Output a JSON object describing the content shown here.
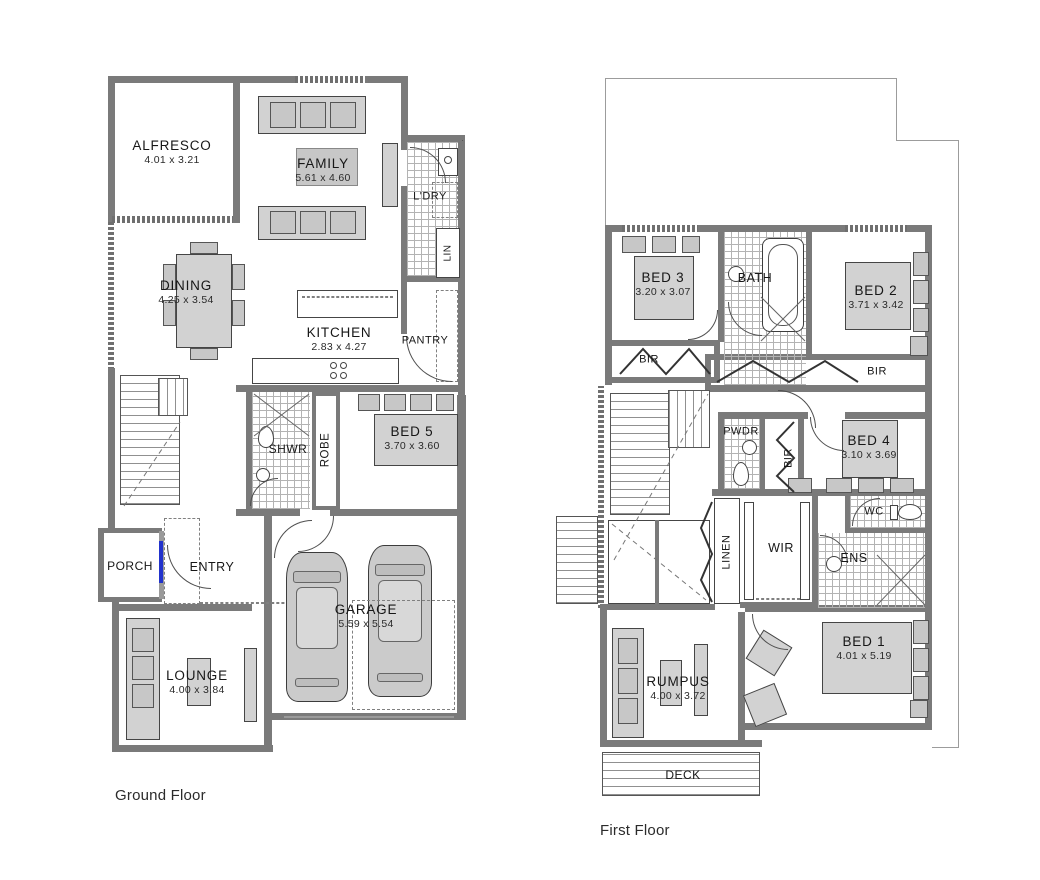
{
  "colors": {
    "wall": "#7a7a7a",
    "furniture_fill": "#d2d2d2",
    "tile_line": "#b3b3b3",
    "front_door_accent": "#2233cc",
    "text": "#1c1c1c",
    "background": "#ffffff"
  },
  "ground": {
    "label": "Ground Floor",
    "rooms": {
      "alfresco": {
        "name": "ALFRESCO",
        "dims": "4.01 x 3.21"
      },
      "family": {
        "name": "FAMILY",
        "dims": "5.61 x 4.60"
      },
      "dining": {
        "name": "DINING",
        "dims": "4.25 x 3.54"
      },
      "kitchen": {
        "name": "KITCHEN",
        "dims": "2.83 x 4.27"
      },
      "ldry": {
        "name": "L'DRY"
      },
      "lin": {
        "name": "LIN"
      },
      "pantry": {
        "name": "PANTRY"
      },
      "shwr": {
        "name": "SHWR"
      },
      "robe": {
        "name": "ROBE"
      },
      "bed5": {
        "name": "BED 5",
        "dims": "3.70 x 3.60"
      },
      "porch": {
        "name": "PORCH"
      },
      "entry": {
        "name": "ENTRY"
      },
      "lounge": {
        "name": "LOUNGE",
        "dims": "4.00 x 3.84"
      },
      "garage": {
        "name": "GARAGE",
        "dims": "5.59 x 5.54"
      }
    }
  },
  "first": {
    "label": "First Floor",
    "rooms": {
      "bed3": {
        "name": "BED 3",
        "dims": "3.20 x 3.07"
      },
      "bath": {
        "name": "BATH"
      },
      "bed2": {
        "name": "BED 2",
        "dims": "3.71 x 3.42"
      },
      "bir_bed3": {
        "name": "BIR"
      },
      "bir_bed2": {
        "name": "BIR"
      },
      "pwdr": {
        "name": "PWDR"
      },
      "bir_bed4": {
        "name": "BIR"
      },
      "bed4": {
        "name": "BED 4",
        "dims": "3.10 x 3.69"
      },
      "linen": {
        "name": "LINEN"
      },
      "wir": {
        "name": "WIR"
      },
      "wc": {
        "name": "WC"
      },
      "ens": {
        "name": "ENS"
      },
      "bed1": {
        "name": "BED 1",
        "dims": "4.01 x 5.19"
      },
      "rumpus": {
        "name": "RUMPUS",
        "dims": "4.00 x 3.72"
      },
      "deck": {
        "name": "DECK"
      }
    }
  }
}
